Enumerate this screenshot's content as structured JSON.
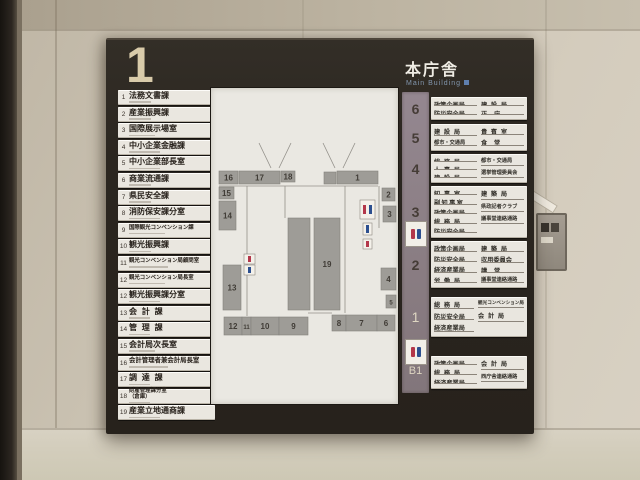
{
  "sign": {
    "floor_large": "1",
    "building_title": "本庁舎",
    "building_subtitle": "Main Building",
    "directory": [
      {
        "no": "1",
        "name": "法務文書課"
      },
      {
        "no": "2",
        "name": "産業振興課"
      },
      {
        "no": "3",
        "name": "国際展示場室"
      },
      {
        "no": "4",
        "name": "中小企業金融課"
      },
      {
        "no": "5",
        "name": "中小企業部長室"
      },
      {
        "no": "6",
        "name": "商業流通課"
      },
      {
        "no": "7",
        "name": "県民安全課"
      },
      {
        "no": "8",
        "name": "消防保安課分室"
      },
      {
        "no": "9",
        "name": "国際観光コンベンション課"
      },
      {
        "no": "10",
        "name": "観光振興課"
      },
      {
        "no": "11",
        "name": "観光コンベンション局顧問室"
      },
      {
        "no": "12",
        "name": "観光コンベンション局長室"
      },
      {
        "no": "12",
        "name": "観光振興課分室"
      },
      {
        "no": "13",
        "name": "会計課"
      },
      {
        "no": "14",
        "name": "管理課"
      },
      {
        "no": "15",
        "name": "会計局次長室"
      },
      {
        "no": "16",
        "name": "会計管理者兼会計局長室"
      },
      {
        "no": "17",
        "name": "調達課"
      },
      {
        "no": "18",
        "name": "財産管理課分室",
        "sub": "（倉庫）"
      },
      {
        "no": "19",
        "name": "産業立地通商課"
      }
    ],
    "floors": [
      {
        "floor": "6",
        "y": 57,
        "h": 23,
        "light": false,
        "left": [
          "政策企画局",
          "防災安全局"
        ],
        "right": [
          "建設局",
          "正庁"
        ]
      },
      {
        "floor": "5",
        "y": 84,
        "h": 27,
        "light": false,
        "left": [
          "建設局",
          "都市・交通局"
        ],
        "right": [
          "貴賓室",
          "食堂"
        ]
      },
      {
        "floor": "4",
        "y": 114,
        "h": 29,
        "light": false,
        "left": [
          "総務局",
          "人事局",
          "建設局"
        ],
        "right": [
          "都市・交通局",
          "選挙管理委員会"
        ]
      },
      {
        "floor": "3",
        "y": 146,
        "h": 52,
        "light": false,
        "left": [
          "知事室",
          "副知事室",
          "政策企画局",
          "総務局",
          "防災安全局"
        ],
        "right": [
          "建築局",
          "県政記者クラブ",
          "議事堂連絡通路"
        ]
      },
      {
        "floor": "2",
        "y": 201,
        "h": 47,
        "light": false,
        "left": [
          "政策企画局",
          "防災安全局",
          "経済産業局",
          "労働局"
        ],
        "right": [
          "建築局",
          "収用委員会",
          "講堂",
          "議事堂連絡通路"
        ]
      },
      {
        "floor": "1",
        "y": 257,
        "h": 40,
        "light": true,
        "left": [
          "総務局",
          "防災安全局",
          "経済産業局"
        ],
        "right": [
          "観光コンベンション局",
          "会計局"
        ]
      },
      {
        "floor": "B1",
        "y": 316,
        "h": 33,
        "light": true,
        "left": [
          "政策企画局",
          "総務局",
          "経済産業局"
        ],
        "right": [
          "会計局",
          "西庁舎連絡通路"
        ]
      }
    ],
    "restroom_positions": [
      181,
      299
    ],
    "map": {
      "rooms": [
        {
          "n": "16",
          "x": 8,
          "y": 83,
          "w": 19,
          "h": 13
        },
        {
          "n": "17",
          "x": 28,
          "y": 83,
          "w": 41,
          "h": 13
        },
        {
          "n": "18",
          "x": 70,
          "y": 83,
          "w": 14,
          "h": 11
        },
        {
          "n": "",
          "x": 113,
          "y": 84,
          "w": 12,
          "h": 12
        },
        {
          "n": "1",
          "x": 126,
          "y": 83,
          "w": 41,
          "h": 13
        },
        {
          "n": "15",
          "x": 8,
          "y": 99,
          "w": 15,
          "h": 12
        },
        {
          "n": "14",
          "x": 8,
          "y": 113,
          "w": 17,
          "h": 29
        },
        {
          "n": "2",
          "x": 171,
          "y": 100,
          "w": 13,
          "h": 13
        },
        {
          "n": "3",
          "x": 172,
          "y": 118,
          "w": 13,
          "h": 16
        },
        {
          "n": "",
          "x": 77,
          "y": 130,
          "w": 22,
          "h": 92
        },
        {
          "n": "19",
          "x": 103,
          "y": 130,
          "w": 26,
          "h": 92
        },
        {
          "n": "13",
          "x": 12,
          "y": 177,
          "w": 18,
          "h": 45
        },
        {
          "n": "12",
          "x": 13,
          "y": 229,
          "w": 18,
          "h": 18
        },
        {
          "n": "11",
          "x": 31,
          "y": 229,
          "w": 9,
          "h": 18
        },
        {
          "n": "10",
          "x": 40,
          "y": 229,
          "w": 28,
          "h": 18
        },
        {
          "n": "9",
          "x": 68,
          "y": 229,
          "w": 29,
          "h": 18
        },
        {
          "n": "8",
          "x": 121,
          "y": 227,
          "w": 14,
          "h": 16
        },
        {
          "n": "7",
          "x": 135,
          "y": 227,
          "w": 31,
          "h": 16
        },
        {
          "n": "6",
          "x": 166,
          "y": 227,
          "w": 18,
          "h": 16
        },
        {
          "n": "4",
          "x": 170,
          "y": 180,
          "w": 15,
          "h": 22
        },
        {
          "n": "5",
          "x": 175,
          "y": 207,
          "w": 10,
          "h": 13
        }
      ],
      "corridors": [
        "M8,98 H167",
        "M36,98 V228",
        "M134,98 V225",
        "M74,98 V130",
        "M97,225 H121",
        "M168,98 V140",
        "M48,55 L60,80",
        "M80,55 L68,80",
        "M112,55 L124,80",
        "M144,55 L132,80"
      ],
      "icons": {
        "restroom": {
          "x": 149,
          "y": 112,
          "w": 15,
          "h": 19
        },
        "chips": [
          {
            "x": 152,
            "y": 135,
            "w": 9,
            "h": 12,
            "c": "#2c4f8f"
          },
          {
            "x": 152,
            "y": 151,
            "w": 9,
            "h": 10,
            "c": "#b3374a"
          },
          {
            "x": 33,
            "y": 166,
            "w": 11,
            "h": 10,
            "c": "#b3374a"
          },
          {
            "x": 33,
            "y": 177,
            "w": 11,
            "h": 10,
            "c": "#2c4f8f"
          }
        ]
      }
    }
  },
  "colors": {
    "sign_bg": "#2b2620",
    "strip_mauve": "#8b7e84",
    "panel_white": "#e9e6df",
    "wall_beige": "#cac2b2",
    "map_room_gray": "#9e9c97",
    "big_numeral_cream": "#d9cbaa",
    "subtitle_blue": "#8296ad",
    "restroom_red": "#b3374a",
    "restroom_blue": "#2c4f8f"
  }
}
